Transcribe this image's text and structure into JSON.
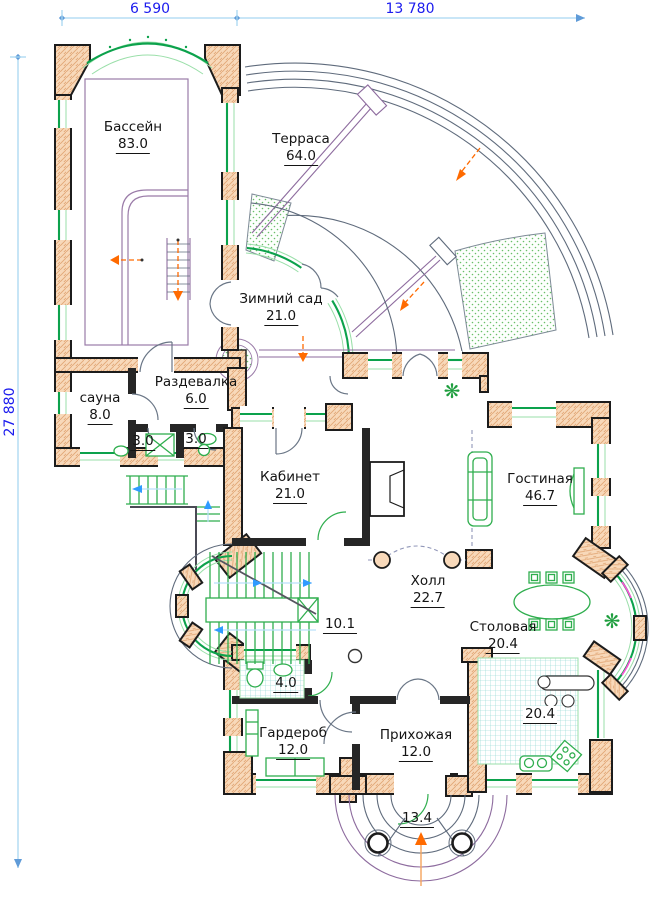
{
  "drawing": {
    "type": "architectural floor plan",
    "language": "ru"
  },
  "dimensions": {
    "top_left": "6 590",
    "top_right": "13 780",
    "left_vertical": "27 880"
  },
  "rooms": {
    "pool": {
      "name": "Бассейн",
      "area": "83.0"
    },
    "terrace": {
      "name": "Терраса",
      "area": "64.0"
    },
    "winter_garden": {
      "name": "Зимний сад",
      "area": "21.0"
    },
    "changing_room": {
      "name": "Раздевалка",
      "area": "6.0"
    },
    "sauna": {
      "name": "сауна",
      "area": "8.0"
    },
    "shower": {
      "area": "3.0"
    },
    "sauna_wc": {
      "area": "3.0"
    },
    "study": {
      "name": "Кабинет",
      "area": "21.0"
    },
    "living_room": {
      "name": "Гостиная",
      "area": "46.7"
    },
    "hall": {
      "name": "Холл",
      "area": "22.7"
    },
    "stairs": {
      "area": "10.1"
    },
    "wc": {
      "area": "4.0"
    },
    "dining_room": {
      "name": "Столовая",
      "area": "20.4"
    },
    "kitchen": {
      "area": "20.4"
    },
    "wardrobe": {
      "name": "Гардероб",
      "area": "12.0"
    },
    "entrance_hall": {
      "name": "Прихожая",
      "area": "12.0"
    },
    "porch": {
      "area": "13.4"
    }
  },
  "icons": {
    "plant": "❋"
  },
  "colors": {
    "wall_fill": "#f8d9ba",
    "wall_hatch": "#e2a877",
    "outline": "#1c1c1c",
    "window_green": "#0ca24c",
    "window_light": "#9adfa9",
    "door_gray": "#6a7686",
    "rail_purple": "#8d6b9e",
    "rail_slate": "#5f6b7c",
    "pool_purple": "#9a7ba8",
    "dimension_text_blue": "#1b1bee",
    "dimension_line_blue": "#a9d7f2",
    "accent_orange": "#ff6a00",
    "stair_arrow_blue": "#2f9bff",
    "tile_teal": "#86d2cf",
    "furniture_green": "#2fae4e",
    "curtain_pink": "#ff4fd8"
  }
}
